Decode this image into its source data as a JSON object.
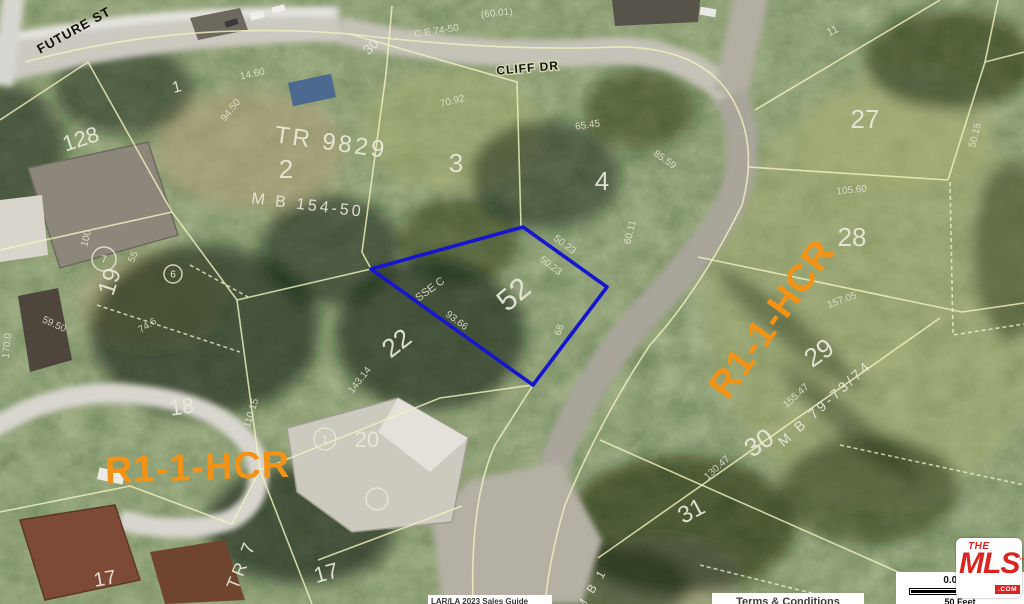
{
  "map": {
    "highlight_parcel": "52",
    "labels": [
      {
        "t": "FUTURE ST",
        "x": 76,
        "y": 34,
        "rot": -29,
        "s": 13,
        "cls": "street",
        "name": "street-label-future-st"
      },
      {
        "t": "CLIFF DR",
        "x": 528,
        "y": 72,
        "rot": -5,
        "s": 12,
        "cls": "street-halo",
        "name": "street-label-cliff-dr"
      },
      {
        "t": "R1-1-HCR",
        "x": 198,
        "y": 480,
        "rot": -2,
        "s": 38,
        "cls": "zoning",
        "name": "zoning-label-left"
      },
      {
        "t": "R1-1-HCR",
        "x": 782,
        "y": 326,
        "rot": -54,
        "s": 38,
        "cls": "zoning",
        "name": "zoning-label-right"
      },
      {
        "t": "TR 9829",
        "x": 330,
        "y": 150,
        "rot": 8,
        "s": 24,
        "cls": "tract",
        "name": "tract-label"
      },
      {
        "t": "M B 154-50",
        "x": 307,
        "y": 210,
        "rot": 7,
        "s": 16,
        "cls": "tract",
        "name": "map-book-label"
      },
      {
        "t": "M B 79-73/74",
        "x": 828,
        "y": 407,
        "rot": -42,
        "s": 14,
        "cls": "tract",
        "name": "map-book-label"
      },
      {
        "t": "TR 7",
        "x": 247,
        "y": 567,
        "rot": -68,
        "s": 18,
        "cls": "tract",
        "name": "tract-label"
      },
      {
        "t": "M B 1",
        "x": 595,
        "y": 591,
        "rot": -58,
        "s": 12,
        "cls": "tract",
        "name": "map-book-label"
      },
      {
        "t": "128",
        "x": 83,
        "y": 146,
        "rot": -18,
        "s": 22,
        "cls": "lot",
        "name": "lot-number"
      },
      {
        "t": "1",
        "x": 178,
        "y": 92,
        "rot": -15,
        "s": 16,
        "cls": "lot",
        "name": "lot-number"
      },
      {
        "t": "2",
        "x": 286,
        "y": 178,
        "rot": 0,
        "s": 26,
        "cls": "lot",
        "name": "lot-number"
      },
      {
        "t": "3",
        "x": 456,
        "y": 172,
        "rot": 0,
        "s": 26,
        "cls": "lot",
        "name": "lot-number"
      },
      {
        "t": "4",
        "x": 602,
        "y": 190,
        "rot": 0,
        "s": 26,
        "cls": "lot",
        "name": "lot-number"
      },
      {
        "t": "52",
        "x": 520,
        "y": 302,
        "rot": -40,
        "s": 30,
        "cls": "lot",
        "name": "lot-number-highlighted"
      },
      {
        "t": "22",
        "x": 402,
        "y": 350,
        "rot": -38,
        "s": 26,
        "cls": "lot",
        "name": "lot-number"
      },
      {
        "t": "19",
        "x": 117,
        "y": 284,
        "rot": -72,
        "s": 24,
        "cls": "lot",
        "name": "lot-number"
      },
      {
        "t": "18",
        "x": 183,
        "y": 414,
        "rot": -8,
        "s": 22,
        "cls": "lot",
        "name": "lot-number"
      },
      {
        "t": "20",
        "x": 367,
        "y": 447,
        "rot": 0,
        "s": 22,
        "cls": "lot",
        "name": "lot-number"
      },
      {
        "t": "17",
        "x": 328,
        "y": 580,
        "rot": -15,
        "s": 22,
        "cls": "lot",
        "name": "lot-number"
      },
      {
        "t": "17",
        "x": 106,
        "y": 585,
        "rot": -10,
        "s": 20,
        "cls": "lot",
        "name": "lot-number"
      },
      {
        "t": "27",
        "x": 865,
        "y": 128,
        "rot": 0,
        "s": 26,
        "cls": "lot",
        "name": "lot-number"
      },
      {
        "t": "28",
        "x": 852,
        "y": 246,
        "rot": 0,
        "s": 26,
        "cls": "lot",
        "name": "lot-number"
      },
      {
        "t": "29",
        "x": 824,
        "y": 360,
        "rot": -35,
        "s": 26,
        "cls": "lot",
        "name": "lot-number"
      },
      {
        "t": "30",
        "x": 764,
        "y": 450,
        "rot": -35,
        "s": 26,
        "cls": "lot",
        "name": "lot-number"
      },
      {
        "t": "31",
        "x": 695,
        "y": 518,
        "rot": -28,
        "s": 24,
        "cls": "lot",
        "name": "lot-number"
      },
      {
        "t": "30",
        "x": 374,
        "y": 50,
        "rot": -45,
        "s": 14,
        "cls": "lot",
        "name": "lot-number"
      },
      {
        "t": "11",
        "x": 834,
        "y": 34,
        "rot": -25,
        "s": 11,
        "cls": "dim",
        "name": "dimension-label"
      },
      {
        "t": "50.23",
        "x": 563,
        "y": 247,
        "rot": 37,
        "s": 10,
        "cls": "dim",
        "name": "dimension-label"
      },
      {
        "t": "50.23",
        "x": 549,
        "y": 268,
        "rot": 37,
        "s": 10,
        "cls": "dim",
        "name": "dimension-label"
      },
      {
        "t": "93.66",
        "x": 455,
        "y": 323,
        "rot": 37,
        "s": 10,
        "cls": "dim",
        "name": "dimension-label"
      },
      {
        "t": "143.14",
        "x": 362,
        "y": 382,
        "rot": -52,
        "s": 10,
        "cls": "dim",
        "name": "dimension-label"
      },
      {
        "t": "110.15",
        "x": 254,
        "y": 414,
        "rot": -73,
        "s": 10,
        "cls": "dim",
        "name": "dimension-label"
      },
      {
        "t": "155.47",
        "x": 798,
        "y": 398,
        "rot": -42,
        "s": 10,
        "cls": "dim",
        "name": "dimension-label"
      },
      {
        "t": "130.47",
        "x": 719,
        "y": 470,
        "rot": -42,
        "s": 10,
        "cls": "dim",
        "name": "dimension-label"
      },
      {
        "t": "157.05",
        "x": 843,
        "y": 303,
        "rot": -20,
        "s": 10,
        "cls": "dim",
        "name": "dimension-label"
      },
      {
        "t": "105.60",
        "x": 852,
        "y": 193,
        "rot": -6,
        "s": 10,
        "cls": "dim",
        "name": "dimension-label"
      },
      {
        "t": "70.92",
        "x": 453,
        "y": 104,
        "rot": -14,
        "s": 10,
        "cls": "dim",
        "name": "dimension-label"
      },
      {
        "t": "65.45",
        "x": 588,
        "y": 128,
        "rot": -8,
        "s": 10,
        "cls": "dim",
        "name": "dimension-label"
      },
      {
        "t": "85.59",
        "x": 663,
        "y": 162,
        "rot": 35,
        "s": 10,
        "cls": "dim",
        "name": "dimension-label"
      },
      {
        "t": "94.50",
        "x": 233,
        "y": 112,
        "rot": -52,
        "s": 10,
        "cls": "dim",
        "name": "dimension-label"
      },
      {
        "t": "14.60",
        "x": 253,
        "y": 77,
        "rot": -12,
        "s": 10,
        "cls": "dim",
        "name": "dimension-label"
      },
      {
        "t": "100",
        "x": 89,
        "y": 239,
        "rot": -76,
        "s": 10,
        "cls": "dim",
        "name": "dimension-label"
      },
      {
        "t": "55",
        "x": 136,
        "y": 258,
        "rot": -68,
        "s": 10,
        "cls": "dim",
        "name": "dimension-label"
      },
      {
        "t": "74.6",
        "x": 149,
        "y": 328,
        "rot": -32,
        "s": 10,
        "cls": "dim",
        "name": "dimension-label"
      },
      {
        "t": "59.50",
        "x": 53,
        "y": 327,
        "rot": 24,
        "s": 10,
        "cls": "dim",
        "name": "dimension-label"
      },
      {
        "t": "170.0",
        "x": 10,
        "y": 346,
        "rot": -84,
        "s": 10,
        "cls": "dim",
        "name": "dimension-label"
      },
      {
        "t": "50.15",
        "x": 978,
        "y": 136,
        "rot": -76,
        "s": 10,
        "cls": "dim",
        "name": "dimension-label"
      },
      {
        "t": "60.11",
        "x": 633,
        "y": 233,
        "rot": -76,
        "s": 10,
        "cls": "dim",
        "name": "dimension-label"
      },
      {
        "t": "68",
        "x": 562,
        "y": 331,
        "rot": -70,
        "s": 10,
        "cls": "dim",
        "name": "dimension-label"
      },
      {
        "t": "(60.01)",
        "x": 497,
        "y": 16,
        "rot": -6,
        "s": 10,
        "cls": "dim",
        "name": "dimension-label"
      },
      {
        "t": "C E 74-50",
        "x": 437,
        "y": 34,
        "rot": -9,
        "s": 10,
        "cls": "dim",
        "name": "dimension-label"
      },
      {
        "t": "SSE C",
        "x": 432,
        "y": 292,
        "rot": -36,
        "s": 11,
        "cls": "dim",
        "name": "easement-label"
      }
    ],
    "markers": [
      {
        "x": 104,
        "y": 259,
        "r": 12,
        "t": "7"
      },
      {
        "x": 173,
        "y": 274,
        "r": 9,
        "t": "6"
      },
      {
        "x": 325,
        "y": 439,
        "r": 11,
        "t": "1"
      },
      {
        "x": 377,
        "y": 499,
        "r": 11,
        "t": ""
      }
    ]
  },
  "overlay": {
    "logo": {
      "the": "THE",
      "mls": "MLS",
      "tm": "™",
      "com": ".COM"
    },
    "scale": {
      "distance": "0.01 Mi",
      "feet": "50 Feet"
    },
    "terms_label": "Terms & Conditions",
    "attribution": "LAR/LA 2023 Sales Guide"
  },
  "colors": {
    "parcel_line": "#f2f2bf",
    "highlight_outline": "#1616cc",
    "zoning_orange": "#f29318",
    "logo_red": "#da2420"
  }
}
